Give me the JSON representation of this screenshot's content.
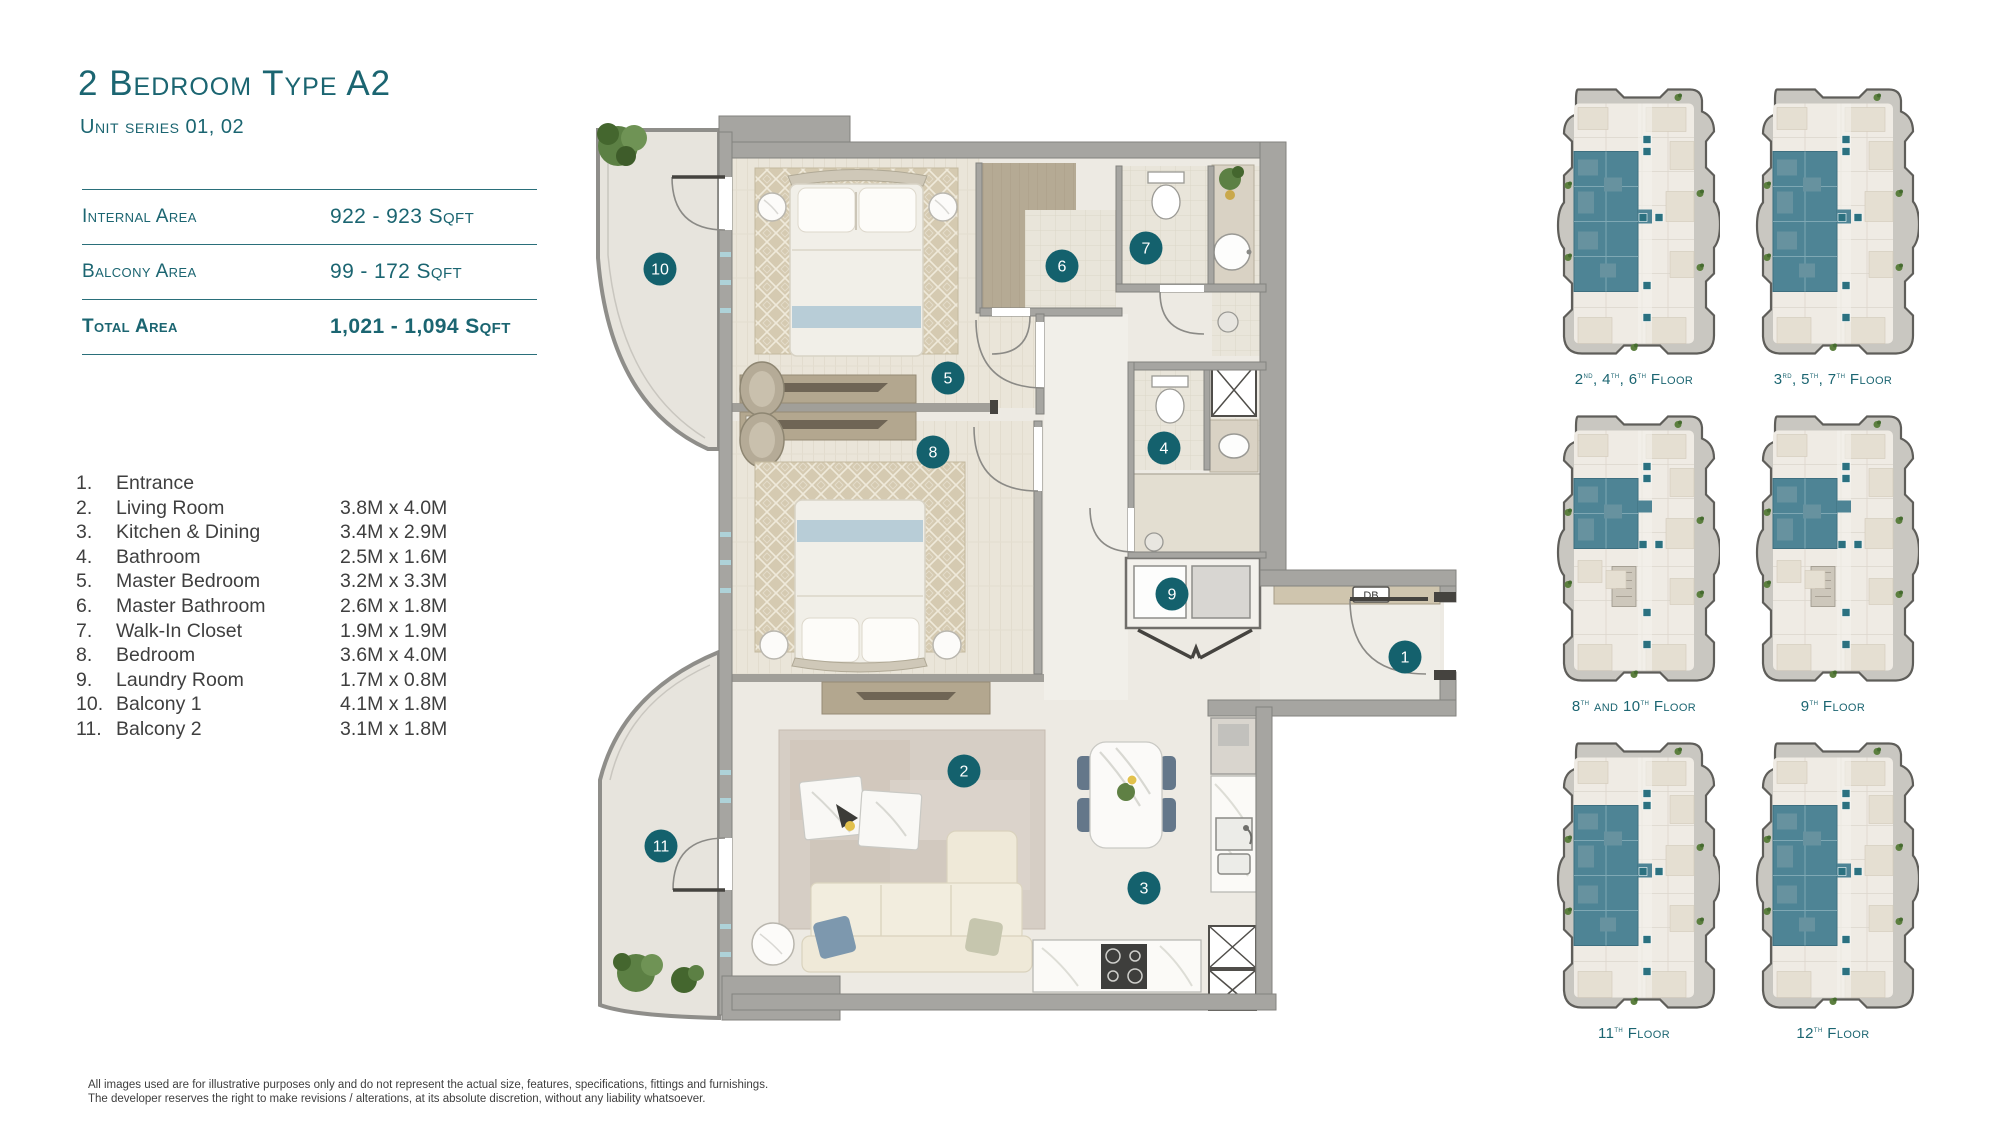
{
  "colors": {
    "accent_teal": "#1b6571",
    "marker_teal": "#14616d",
    "highlight_teal": "#4e8495",
    "wall_gray": "#a6a5a1",
    "text_dark": "#3f3f3f"
  },
  "header": {
    "title": "2 Bedroom Type A2",
    "subtitle": "Unit series 01, 02"
  },
  "areas": {
    "rows": [
      {
        "label": "Internal Area",
        "value": "922 - 923 Sqft",
        "bold": false
      },
      {
        "label": "Balcony Area",
        "value": "99 - 172 Sqft",
        "bold": false
      },
      {
        "label": "Total Area",
        "value": "1,021 - 1,094 Sqft",
        "bold": true
      }
    ]
  },
  "rooms": [
    {
      "num": "1.",
      "name": "Entrance",
      "dims": ""
    },
    {
      "num": "2.",
      "name": "Living Room",
      "dims": "3.8M x 4.0M"
    },
    {
      "num": "3.",
      "name": "Kitchen & Dining",
      "dims": "3.4M x 2.9M"
    },
    {
      "num": "4.",
      "name": "Bathroom",
      "dims": "2.5M x 1.6M"
    },
    {
      "num": "5.",
      "name": "Master Bedroom",
      "dims": "3.2M x 3.3M"
    },
    {
      "num": "6.",
      "name": "Master Bathroom",
      "dims": "2.6M x 1.8M"
    },
    {
      "num": "7.",
      "name": "Walk-In Closet",
      "dims": "1.9M x 1.9M"
    },
    {
      "num": "8.",
      "name": "Bedroom",
      "dims": "3.6M x 4.0M"
    },
    {
      "num": "9.",
      "name": "Laundry Room",
      "dims": "1.7M x 0.8M"
    },
    {
      "num": "10.",
      "name": "Balcony 1",
      "dims": "4.1M x 1.8M"
    },
    {
      "num": "11.",
      "name": "Balcony 2",
      "dims": "3.1M x 1.8M"
    }
  ],
  "plan": {
    "db_label": "DB",
    "markers": [
      {
        "n": "1",
        "x": 845,
        "y": 577
      },
      {
        "n": "2",
        "x": 404,
        "y": 691
      },
      {
        "n": "3",
        "x": 584,
        "y": 808
      },
      {
        "n": "4",
        "x": 604,
        "y": 368
      },
      {
        "n": "5",
        "x": 388,
        "y": 298
      },
      {
        "n": "6",
        "x": 502,
        "y": 186
      },
      {
        "n": "7",
        "x": 586,
        "y": 168
      },
      {
        "n": "8",
        "x": 373,
        "y": 372
      },
      {
        "n": "9",
        "x": 612,
        "y": 514
      },
      {
        "n": "10",
        "x": 100,
        "y": 189
      },
      {
        "n": "11",
        "x": 101,
        "y": 766
      }
    ]
  },
  "floor_plates": [
    {
      "label": "2nd, 4th, 6th Floor",
      "variant": "both"
    },
    {
      "label": "3rd, 5th, 7th Floor",
      "variant": "both"
    },
    {
      "label": "8th and 10th Floor",
      "variant": "top"
    },
    {
      "label": "9th Floor",
      "variant": "top"
    },
    {
      "label": "11th Floor",
      "variant": "both"
    },
    {
      "label": "12th Floor",
      "variant": "both"
    }
  ],
  "disclaimer": {
    "line1": "All images used are for illustrative purposes only and do not represent the actual size, features, specifications, fittings and furnishings.",
    "line2": "The developer reserves the right to make revisions / alterations, at its absolute discretion, without any liability whatsoever."
  }
}
